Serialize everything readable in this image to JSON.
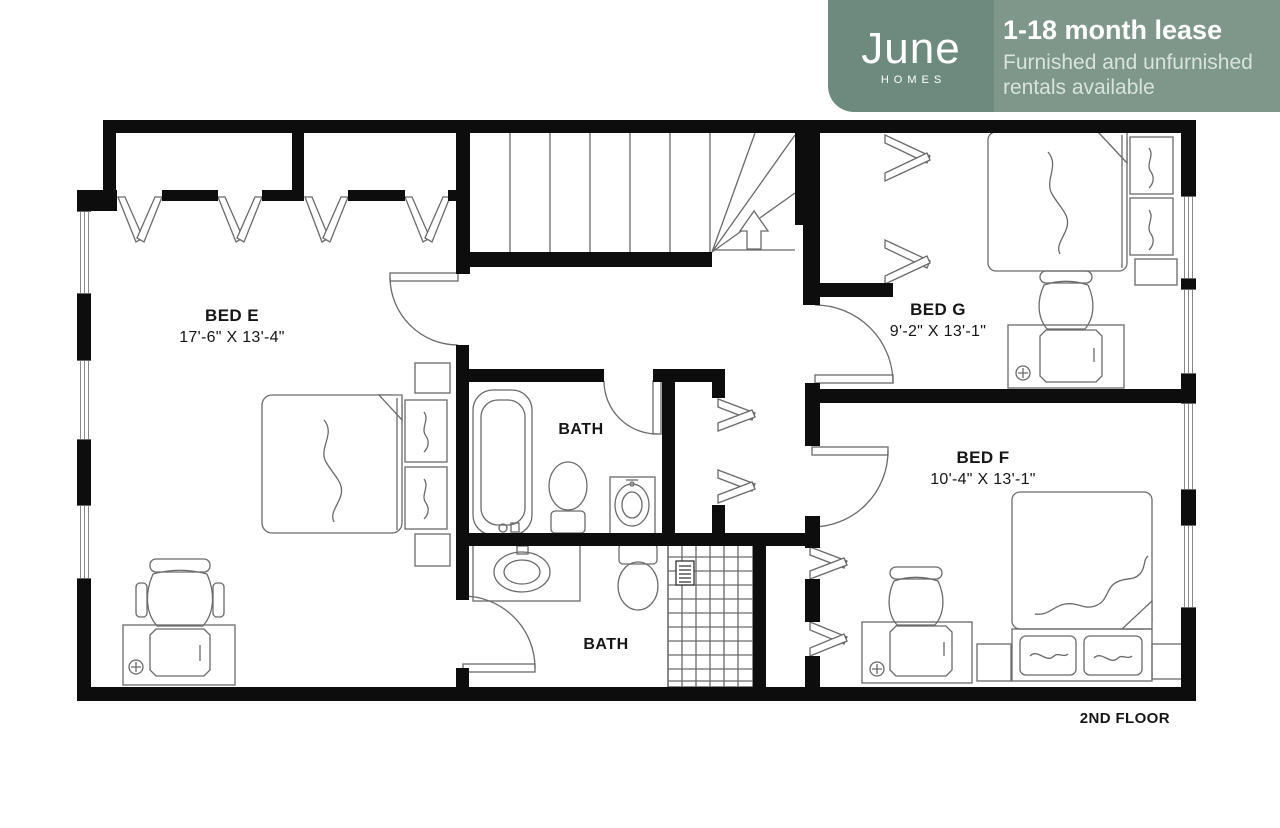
{
  "brand": {
    "logo": "June",
    "logo_sub": "HOMES",
    "headline": "1-18 month lease",
    "subline1": "Furnished and unfurnished",
    "subline2": "rentals available",
    "colors": {
      "badge_left": "#6d8a7e",
      "badge_right": "#7f978b",
      "subtext": "#d7e3dc"
    }
  },
  "rooms": [
    {
      "name": "BED E",
      "dims": "17'-6\" X 13'-4\""
    },
    {
      "name": "BED G",
      "dims": "9'-2\" X 13'-1\""
    },
    {
      "name": "BED F",
      "dims": "10'-4\" X 13'-1\""
    },
    {
      "name": "BATH"
    },
    {
      "name": "BATH"
    }
  ],
  "floor_label": "2ND FLOOR",
  "colors": {
    "wall": "#0d0d0d",
    "line": "#6a6a6a",
    "background": "#ffffff"
  }
}
